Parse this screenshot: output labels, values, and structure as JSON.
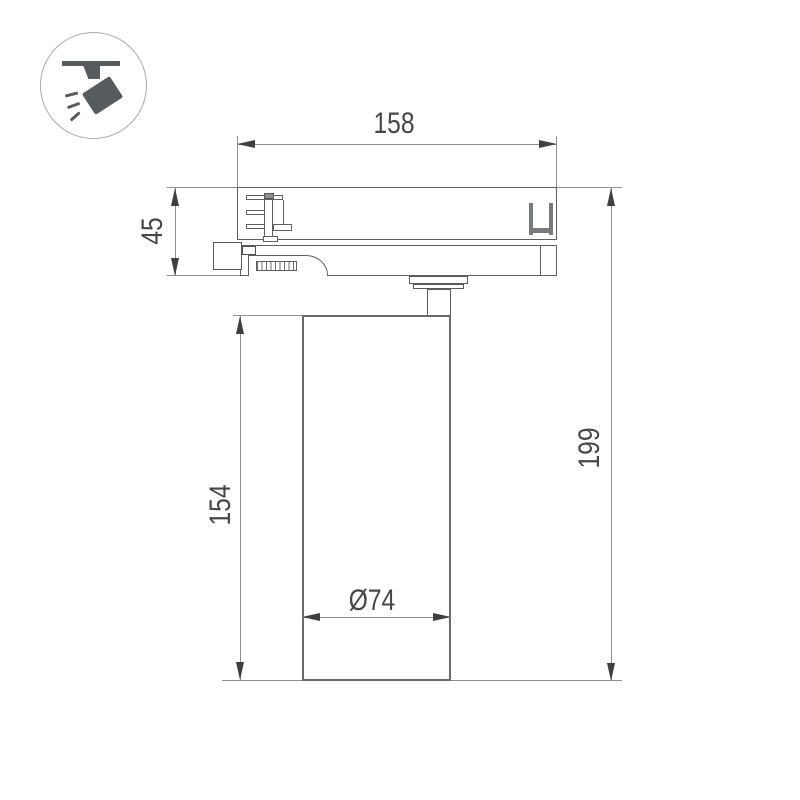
{
  "drawing": {
    "type": "technical-dimension-drawing",
    "subject": "track-mounted-spotlight-side-view",
    "dimensions": {
      "adapter_width": "158",
      "adapter_height": "45",
      "body_height": "154",
      "overall_height": "199",
      "body_diameter": "Ø74"
    }
  },
  "icon": {
    "name": "track-spotlight-icon"
  },
  "colors": {
    "background": "#ffffff",
    "dimension_line": "#8f8f8f",
    "object_line": "#5f5f5f",
    "arrow": "#3f3f3f",
    "text": "#474747",
    "icon": "#565b5d"
  }
}
